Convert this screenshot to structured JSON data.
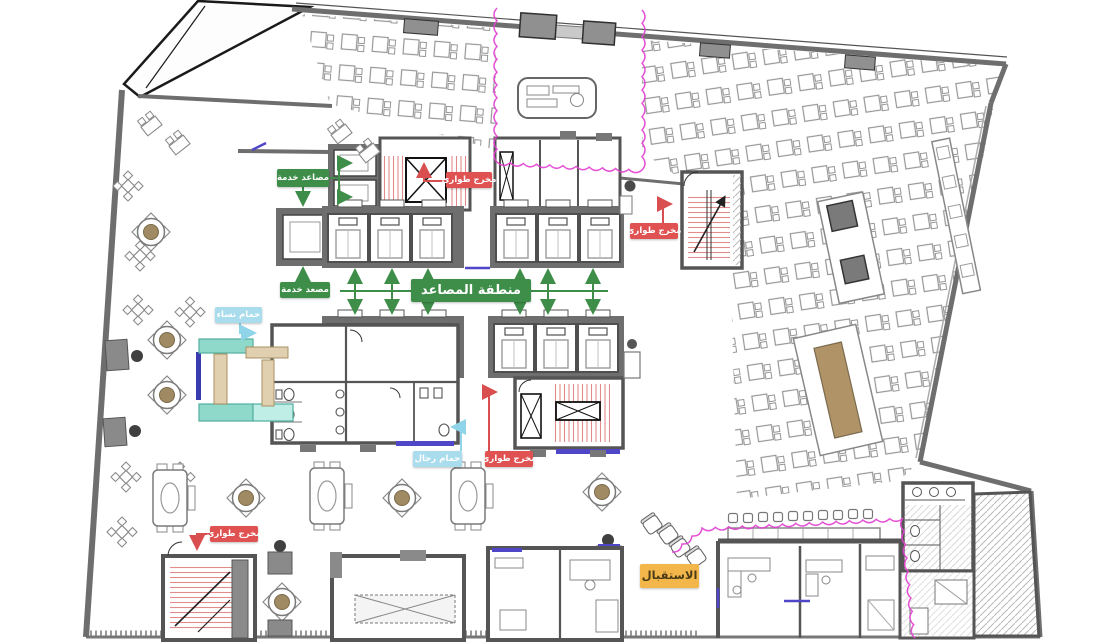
{
  "plan_labels": {
    "service_elevators": "مصاعد خدمة",
    "service_elevator": "مصعد خدمة",
    "elevators_area": "منطقة المصاعد",
    "emergency_exit_top": "مخرج طوارئ",
    "emergency_exit_right": "مخرج طوارئ",
    "emergency_exit_center": "مخرج طوارئ",
    "emergency_exit_bottom_left": "مخرج طوارئ",
    "women_bathroom": "حمام نساء",
    "men_bathroom": "حمام رجال",
    "reception": "الاستقبال"
  },
  "colors": {
    "label_green": "#3e8e49",
    "label_red": "#e05252",
    "label_blue": "#a9dcec",
    "label_orange": "#f3b64b",
    "wall_gray": "#6e6e6e",
    "revision_magenta": "#e23fd0",
    "door_blue": "#4f46c8",
    "stair_tread_red": "#e38a8a",
    "sofa_teal": "#8fd9cb",
    "wood_tan": "#e0d0b0"
  }
}
